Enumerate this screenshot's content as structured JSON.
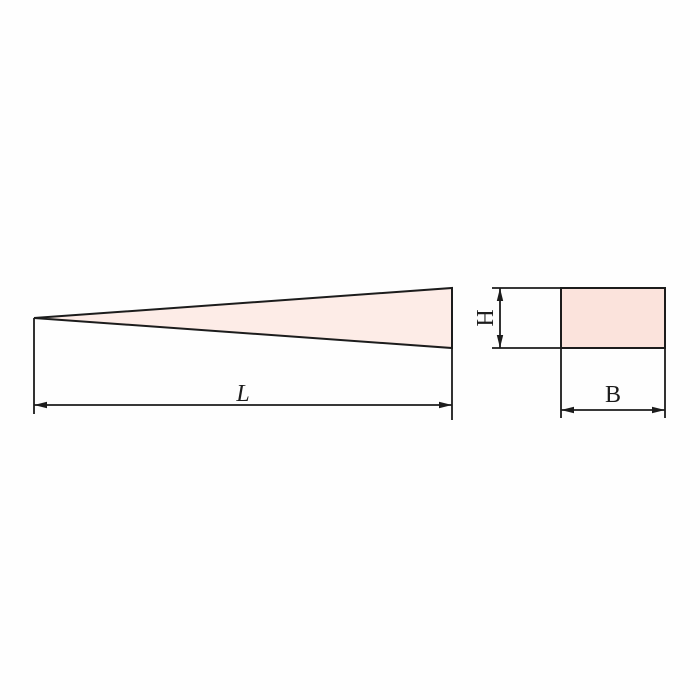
{
  "diagram": {
    "labels": {
      "length": "L",
      "height": "H",
      "width": "B"
    },
    "colors": {
      "line": "#1c1c1c",
      "wedge_fill": "#fdece7",
      "section_fill": "#fbe3dc",
      "background": "#fefefe"
    }
  }
}
